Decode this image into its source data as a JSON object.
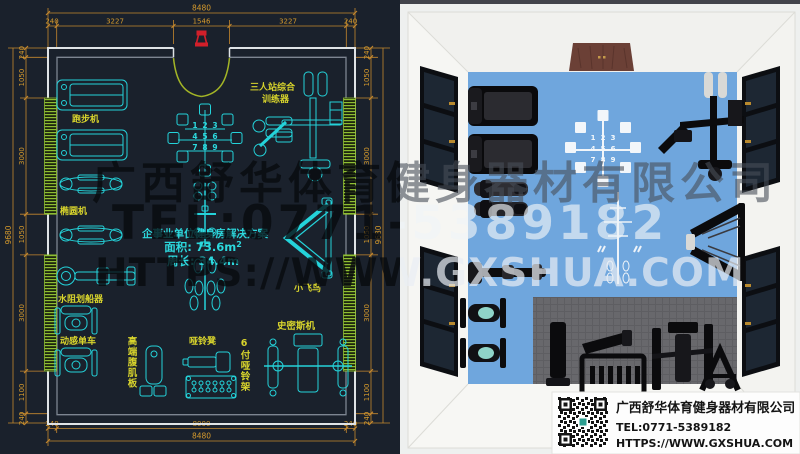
{
  "watermark": {
    "line1": "广西舒华体育健身器材有限公司",
    "line2": "TEL:0771-5389182",
    "line3": "HTTPS://WWW.GXSHUA.COM"
  },
  "cad": {
    "dims": {
      "top_total": "8480",
      "top": [
        "240",
        "3227",
        "1546",
        "3227",
        "240"
      ],
      "bottom": [
        "240",
        "8000",
        "240"
      ],
      "bottom_total": "8480",
      "side": [
        "240",
        "1050",
        "3000",
        "1050",
        "3000",
        "1100",
        "240"
      ],
      "side_total": "9680"
    },
    "labels": {
      "treadmill": "跑步机",
      "elliptical": "椭圆机",
      "rower": "水阻划船器",
      "spin_bike": "动感单车",
      "ab_board": "高端腹肌板",
      "dumbbell_bench": "哑铃凳",
      "dumbbell_rack": "6付哑铃架",
      "smith": "史密斯机",
      "fly": "小飞鸟",
      "multi_station_1": "三人站综合",
      "multi_station_2": "训练器"
    },
    "solution": {
      "title": "企事业单位健身房解决方案",
      "area": "面积: 73.6m",
      "area_sup": "2",
      "perimeter": "周长: 34.4m"
    },
    "rack_numbers": [
      "1",
      "2",
      "3",
      "4",
      "5",
      "6",
      "7",
      "8",
      "9"
    ]
  },
  "info_box": {
    "company": "广西舒华体育健身器材有限公司",
    "tel": "TEL:0771-5389182",
    "url": "HTTPS://WWW.GXSHUA.COM"
  },
  "colors": {
    "cad_background": "#1a212c",
    "cad_line_cyan": "#24d3da",
    "cad_label_yellow": "#d8d42c",
    "cad_dim_orange": "#d59a2c",
    "window_green": "#8fbe33",
    "entrance_red": "#d21f2a",
    "floor_blue": "#6fa6dd",
    "door_brown": "#6b4036"
  }
}
